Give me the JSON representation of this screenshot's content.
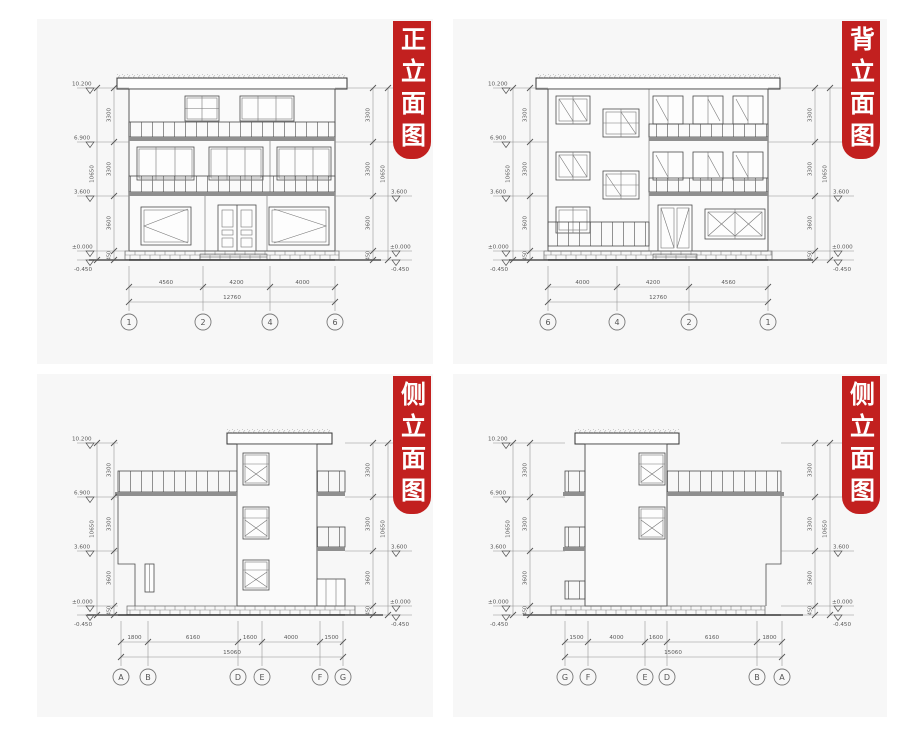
{
  "colors": {
    "banner_red": "#c2201f",
    "paper": "#f7f7f7"
  },
  "banners": {
    "front": "正立面图",
    "back": "背立面图",
    "side": "侧立面图"
  },
  "shared": {
    "levels": [
      "10.200",
      "6.900",
      "3.600",
      "±0.000",
      "-0.450"
    ],
    "vdims": [
      "3300",
      "3300",
      "3600",
      "450",
      "10650"
    ]
  },
  "front": {
    "hsegs": [
      "4560",
      "4200",
      "4000"
    ],
    "htotal": "12760",
    "axes": [
      "1",
      "2",
      "4",
      "6"
    ]
  },
  "back": {
    "hsegs": [
      "4000",
      "4200",
      "4560"
    ],
    "htotal": "12760",
    "axes": [
      "6",
      "4",
      "2",
      "1"
    ]
  },
  "side_a": {
    "hsegs": [
      "1800",
      "6160",
      "1600",
      "4000",
      "1500"
    ],
    "htotal": "15060",
    "axes": [
      "A",
      "B",
      "D",
      "E",
      "F",
      "G"
    ]
  },
  "side_b": {
    "hsegs": [
      "1500",
      "4000",
      "1600",
      "6160",
      "1800"
    ],
    "htotal": "15060",
    "axes": [
      "G",
      "F",
      "E",
      "D",
      "B",
      "A"
    ]
  }
}
